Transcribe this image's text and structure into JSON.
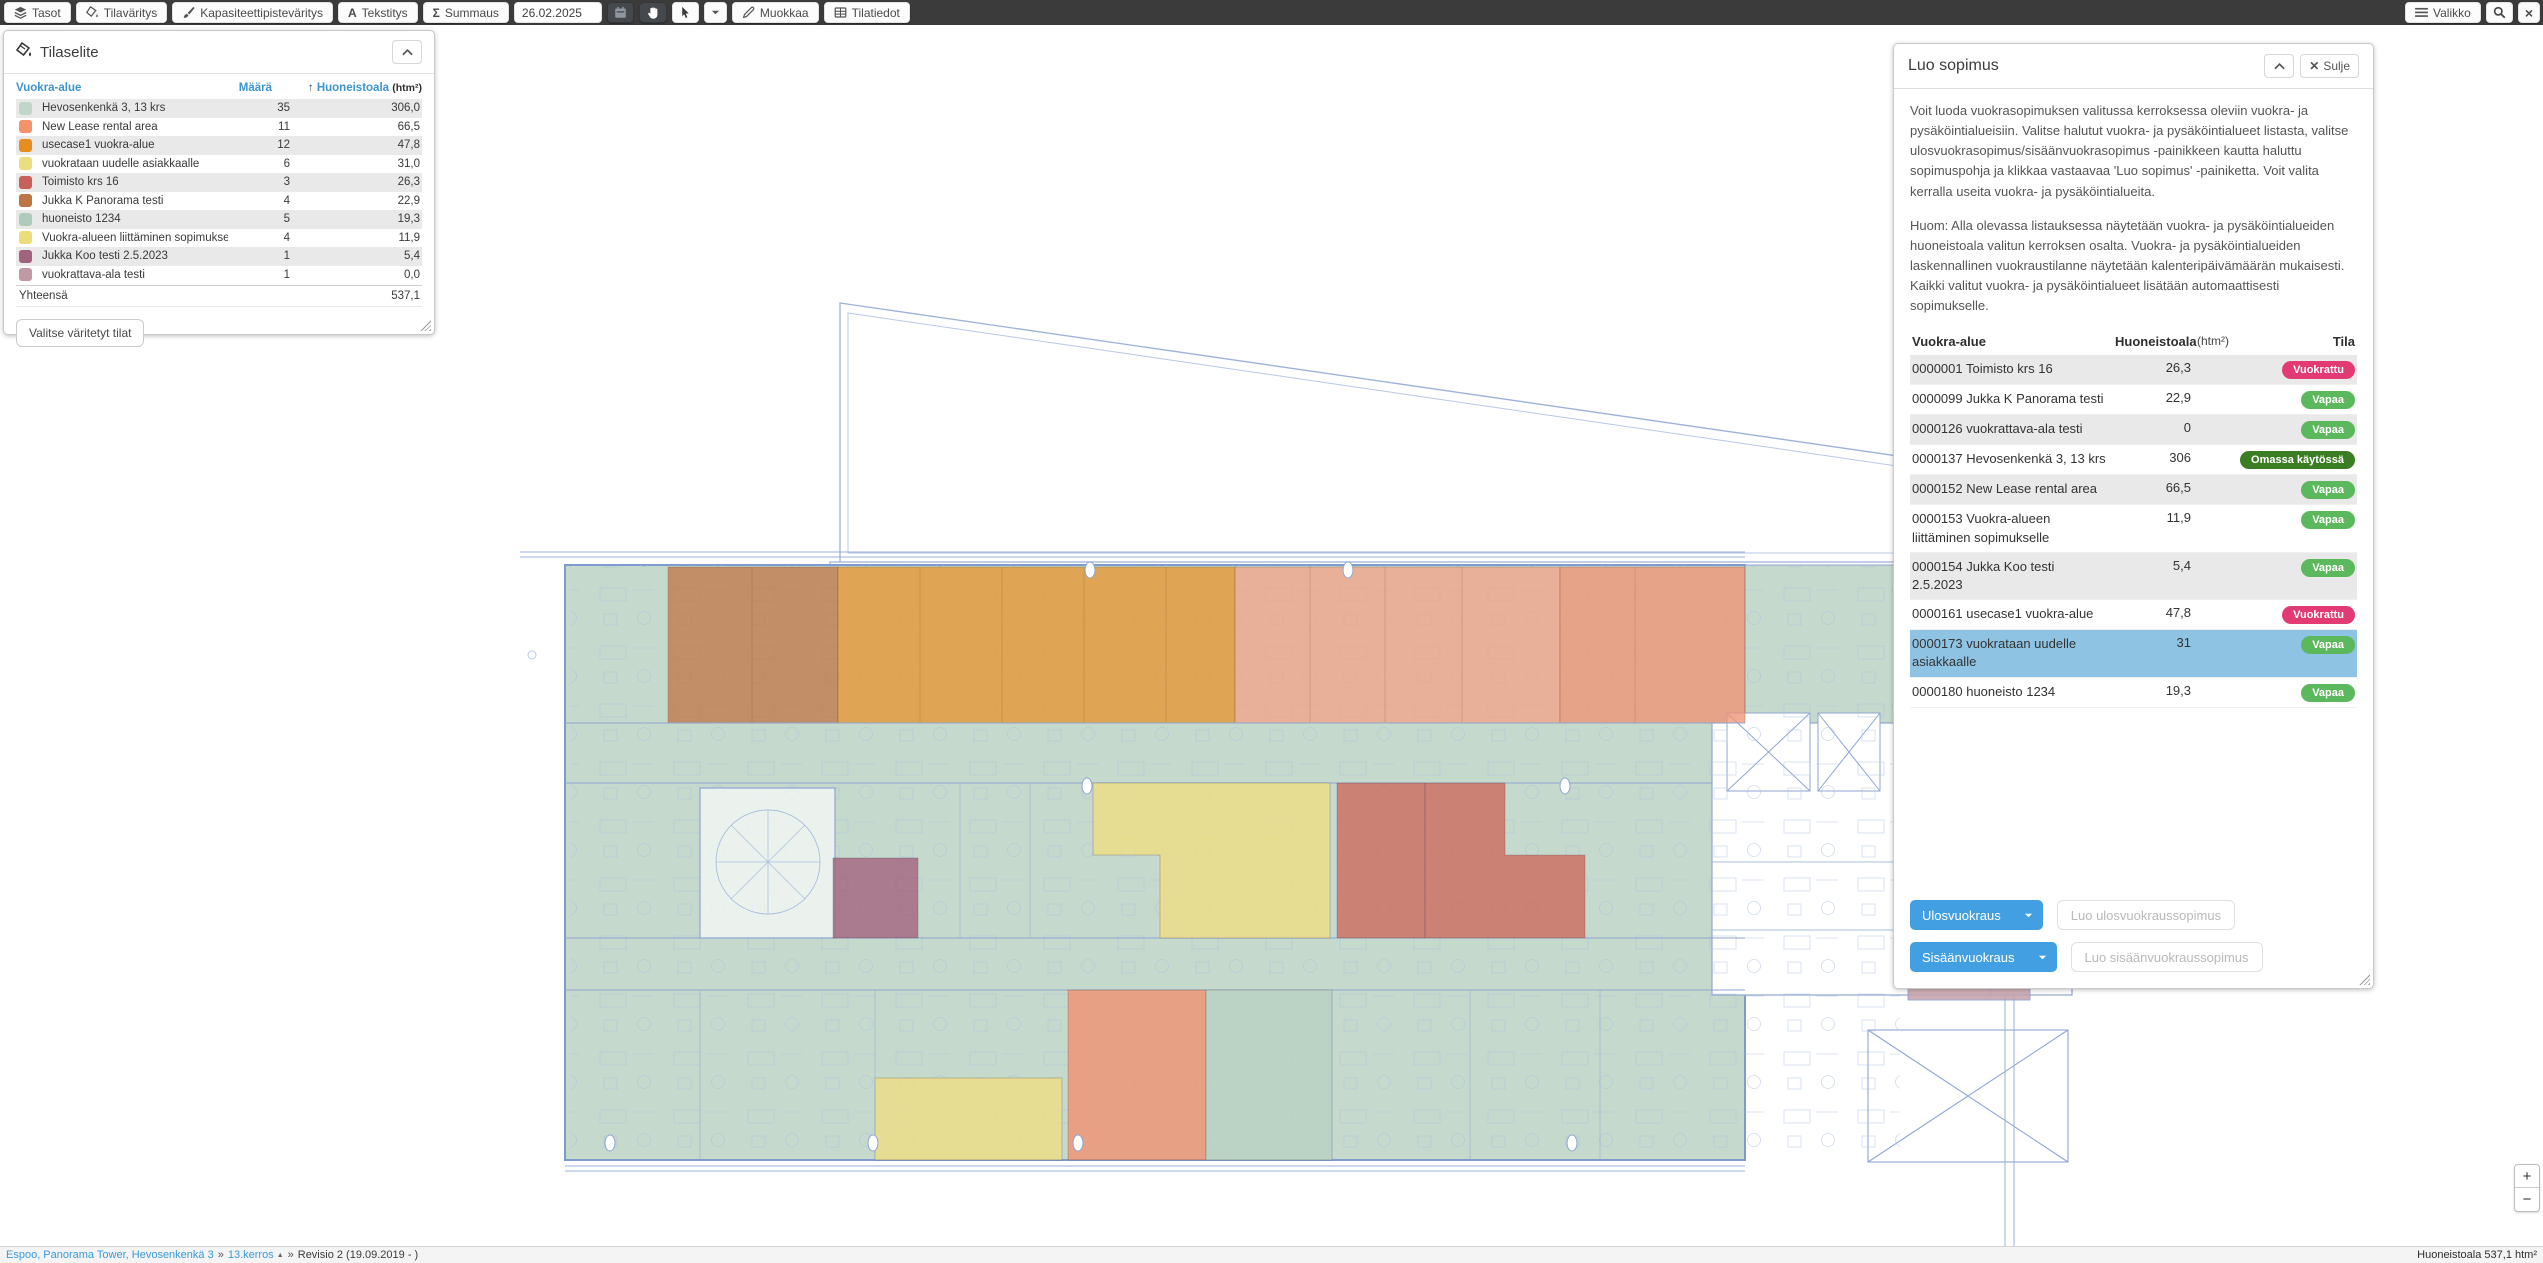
{
  "toolbar": {
    "tasot": "Tasot",
    "tilavaritys": "Tilaväritys",
    "kapasiteetti": "Kapasiteettipisteväritys",
    "tekstitys": "Tekstitys",
    "summaus": "Summaus",
    "sigma": "Σ",
    "text_a": "A",
    "date_value": "26.02.2025",
    "muokkaa": "Muokkaa",
    "tilatiedot": "Tilatiedot",
    "valikko": "Valikko",
    "close": "×"
  },
  "legend_panel": {
    "title": "Tilaselite",
    "columns": {
      "area": "Vuokra-alue",
      "count": "Määrä",
      "sort_arrow": "↑",
      "floor_area": "Huoneistoala",
      "unit": "(htm²)"
    },
    "rows": [
      {
        "name": "Hevosenkenkä 3, 13 krs",
        "count": "35",
        "area": "306,0",
        "color": "#bfd6c9"
      },
      {
        "name": "New Lease rental area",
        "count": "11",
        "area": "66,5",
        "color": "#f4926a"
      },
      {
        "name": "usecase1 vuokra-alue",
        "count": "12",
        "area": "47,8",
        "color": "#e88d20"
      },
      {
        "name": "vuokrataan uudelle asiakkaalle",
        "count": "6",
        "area": "31,0",
        "color": "#ecdc82"
      },
      {
        "name": "Toimisto krs 16",
        "count": "3",
        "area": "26,3",
        "color": "#c96058"
      },
      {
        "name": "Jukka K Panorama testi",
        "count": "4",
        "area": "22,9",
        "color": "#bd7544"
      },
      {
        "name": "huoneisto 1234",
        "count": "5",
        "area": "19,3",
        "color": "#aecbbc"
      },
      {
        "name": "Vuokra-alueen liittäminen sopimukselle",
        "count": "4",
        "area": "11,9",
        "color": "#ecdc7a"
      },
      {
        "name": "Jukka Koo testi 2.5.2023",
        "count": "1",
        "area": "5,4",
        "color": "#a2627e"
      },
      {
        "name": "vuokrattava-ala testi",
        "count": "1",
        "area": "0,0",
        "color": "#bf9aa4"
      }
    ],
    "total_label": "Yhteensä",
    "total_value": "537,1",
    "select_button": "Valitse väritetyt tilat"
  },
  "contract_panel": {
    "title": "Luo sopimus",
    "close_label": "Sulje",
    "close_x": "✕",
    "paragraph1": "Voit luoda vuokrasopimuksen valitussa kerroksessa oleviin vuokra- ja pysäköintialueisiin. Valitse halutut vuokra- ja pysäköintialueet listasta, valitse ulosvuokrasopimus/sisäänvuokrasopimus -painikkeen kautta haluttu sopimuspohja ja klikkaa vastaavaa 'Luo sopimus' -painiketta. Voit valita kerralla useita vuokra- ja pysäköintialueita.",
    "paragraph2": "Huom: Alla olevassa listauksessa näytetään vuokra- ja pysäköintialueiden huoneistoala valitun kerroksen osalta. Vuokra- ja pysäköintialueiden laskennallinen vuokraustilanne näytetään kalenteripäivämäärän mukaisesti. Kaikki valitut vuokra- ja pysäköintialueet lisätään automaattisesti sopimukselle.",
    "columns": {
      "area": "Vuokra-alue",
      "floor_area": "Huoneistoala",
      "unit": "(htm²)",
      "status": "Tila"
    },
    "rows": [
      {
        "name": "0000001 Toimisto krs 16",
        "area": "26,3",
        "status": "Vuokrattu",
        "status_type": "rented",
        "selected": false
      },
      {
        "name": "0000099 Jukka K Panorama testi",
        "area": "22,9",
        "status": "Vapaa",
        "status_type": "free",
        "selected": false
      },
      {
        "name": "0000126 vuokrattava-ala testi",
        "area": "0",
        "status": "Vapaa",
        "status_type": "free",
        "selected": false
      },
      {
        "name": "0000137 Hevosenkenkä 3, 13 krs",
        "area": "306",
        "status": "Omassa käytössä",
        "status_type": "own",
        "selected": false
      },
      {
        "name": "0000152 New Lease rental area",
        "area": "66,5",
        "status": "Vapaa",
        "status_type": "free",
        "selected": false
      },
      {
        "name": "0000153 Vuokra-alueen liittäminen sopimukselle",
        "area": "11,9",
        "status": "Vapaa",
        "status_type": "free",
        "selected": false
      },
      {
        "name": "0000154 Jukka Koo testi 2.5.2023",
        "area": "5,4",
        "status": "Vapaa",
        "status_type": "free",
        "selected": false
      },
      {
        "name": "0000161 usecase1 vuokra-alue",
        "area": "47,8",
        "status": "Vuokrattu",
        "status_type": "rented",
        "selected": false
      },
      {
        "name": "0000173 vuokrataan uudelle asiakkaalle",
        "area": "31",
        "status": "Vapaa",
        "status_type": "free",
        "selected": true
      },
      {
        "name": "0000180 huoneisto 1234",
        "area": "19,3",
        "status": "Vapaa",
        "status_type": "free",
        "selected": false
      }
    ],
    "buttons": {
      "out_dropdown": "Ulosvuokraus",
      "out_create": "Luo ulosvuokraussopimus",
      "in_dropdown": "Sisäänvuokraus",
      "in_create": "Luo sisäänvuokraussopimus"
    }
  },
  "statusbar": {
    "breadcrumb_location": "Espoo, Panorama Tower, Hevosenkenkä 3",
    "separator": "»",
    "breadcrumb_floor": "13.kerros",
    "floor_caret": "▲",
    "revision": "Revisio 2 (19.09.2019 - )",
    "right_text": "Huoneistoala 537,1 htm²"
  },
  "zoom_controls": {
    "zoom_in": "+",
    "zoom_out": "−"
  },
  "colors": {
    "selection_highlight": "#8fc3e3",
    "badge_rented": "#e23a72",
    "badge_free": "#5cb85c",
    "badge_own_use": "#3b7d22",
    "plan_line": "#8fa6d2",
    "plan_base_fill": "#c5dacd",
    "accent_blue_button": "#42a0e2",
    "link_blue": "#3a9ad9"
  }
}
